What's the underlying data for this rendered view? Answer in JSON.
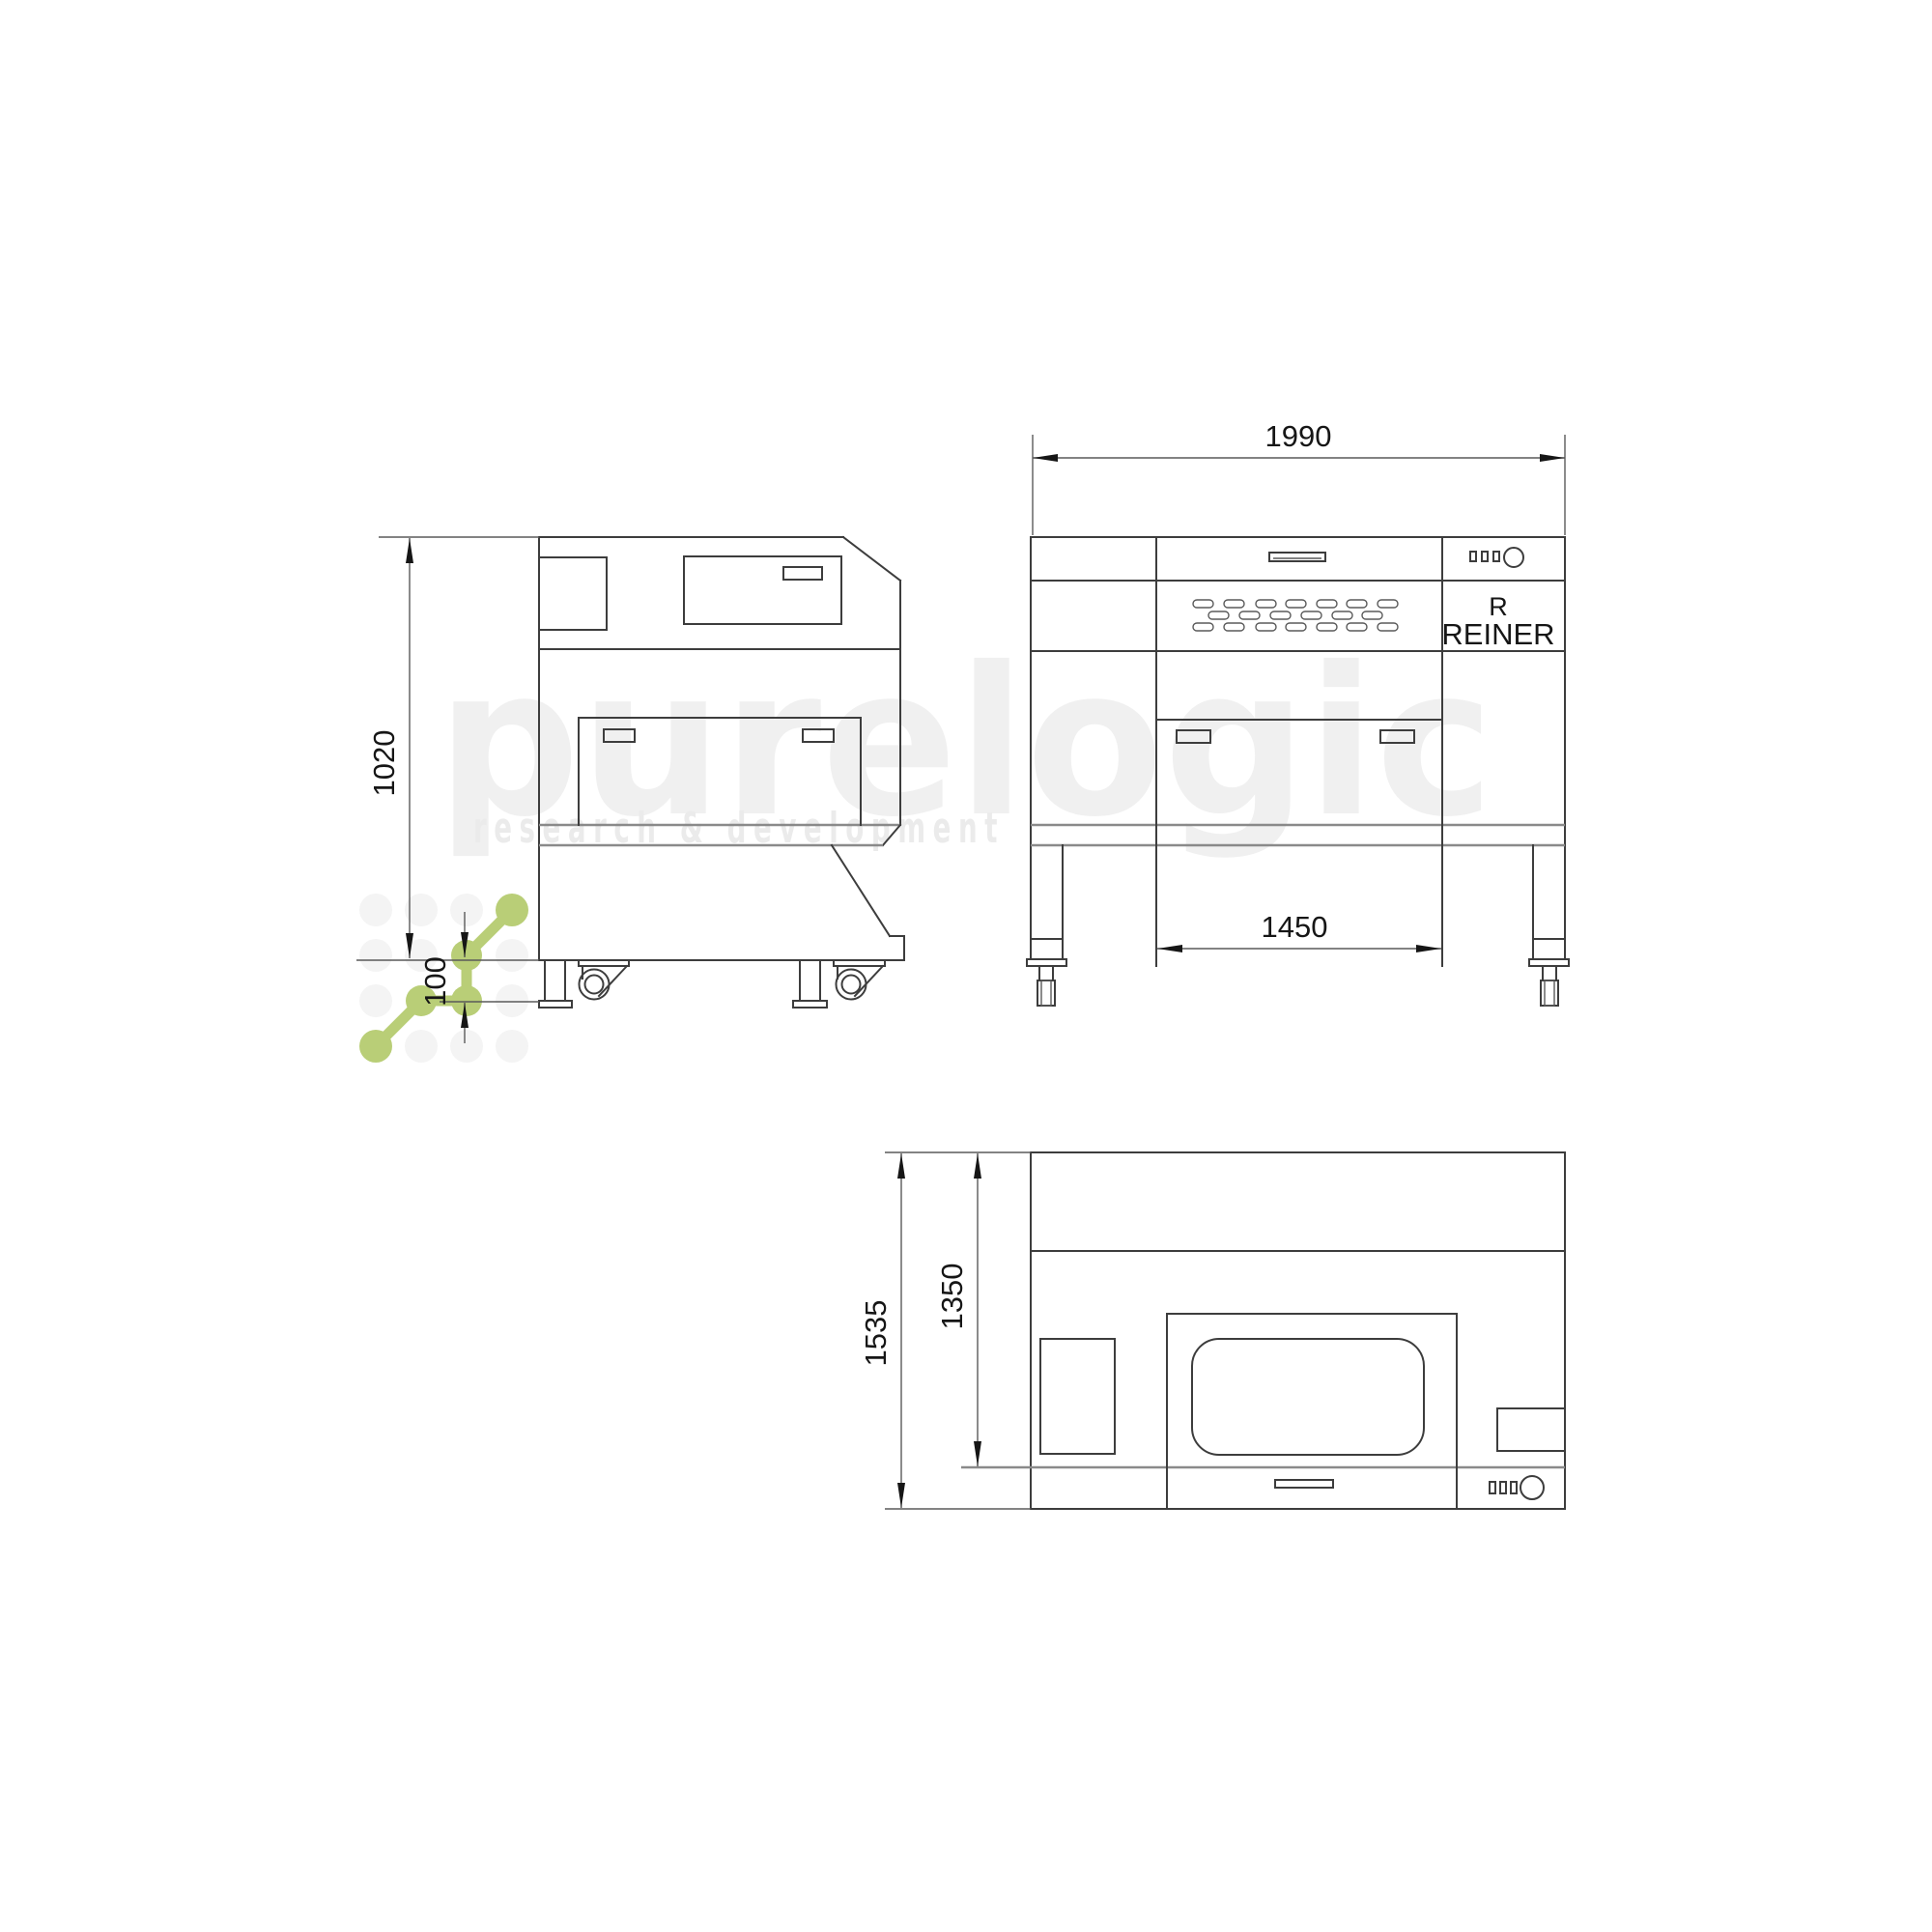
{
  "watermark": {
    "word": "purelogic",
    "subtitle": "research & development",
    "logo_color": "#b9ce77",
    "dot_color": "#f4f4f4",
    "word_color": "#f0f0f0",
    "subtitle_color": "#ebebeb"
  },
  "side_view": {
    "dim_height": "1020",
    "dim_foot_height": "100"
  },
  "front_view": {
    "dim_width": "1990",
    "dim_span": "1450",
    "brand_initial": "R",
    "brand_name": "REINER"
  },
  "top_view": {
    "dim_depth_total": "1535",
    "dim_depth_body": "1350"
  },
  "drawing": {
    "line_color": "#3d3d3d",
    "dim_color": "#161616"
  }
}
